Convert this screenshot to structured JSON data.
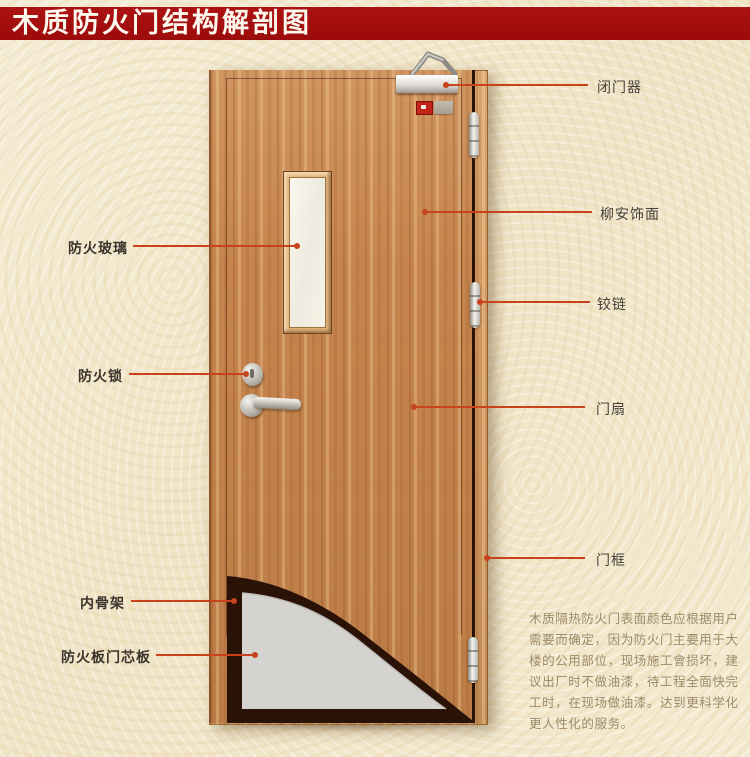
{
  "title": "木质防火门结构解剖图",
  "colors": {
    "title_bar": "#9c0b0b",
    "title_text": "#fdf8ee",
    "background": "#f2e7cb",
    "leader_line": "#c8421c",
    "label_text": "#3b342c",
    "description_text": "#9c8b6a",
    "door_wood": "#c6854e",
    "frame_wood": "#d0985f",
    "core_panel": "#d4d3cf",
    "inner_frame_dark": "#2a1206"
  },
  "labels": {
    "left": [
      {
        "id": "fire-glass",
        "text": "防火玻璃"
      },
      {
        "id": "fire-lock",
        "text": "防火锁"
      },
      {
        "id": "inner-frame",
        "text": "内骨架"
      },
      {
        "id": "fire-core-panel",
        "text": "防火板门芯板"
      }
    ],
    "right": [
      {
        "id": "door-closer",
        "text": "闭门器"
      },
      {
        "id": "veneer",
        "text": "柳安饰面"
      },
      {
        "id": "hinge",
        "text": "铰链"
      },
      {
        "id": "door-leaf",
        "text": "门扇"
      },
      {
        "id": "door-frame",
        "text": "门框"
      }
    ]
  },
  "description_lines": [
    "木质隔热防火门表面颜色应根据用户",
    "需要而确定，因为防火门主要用于大",
    "楼的公用部位，现场施工會损坏，建",
    "议出厂时不做油漆，待工程全面快完",
    "工时，在现场做油漆。达到更科学化",
    "更人性化的服务。"
  ]
}
